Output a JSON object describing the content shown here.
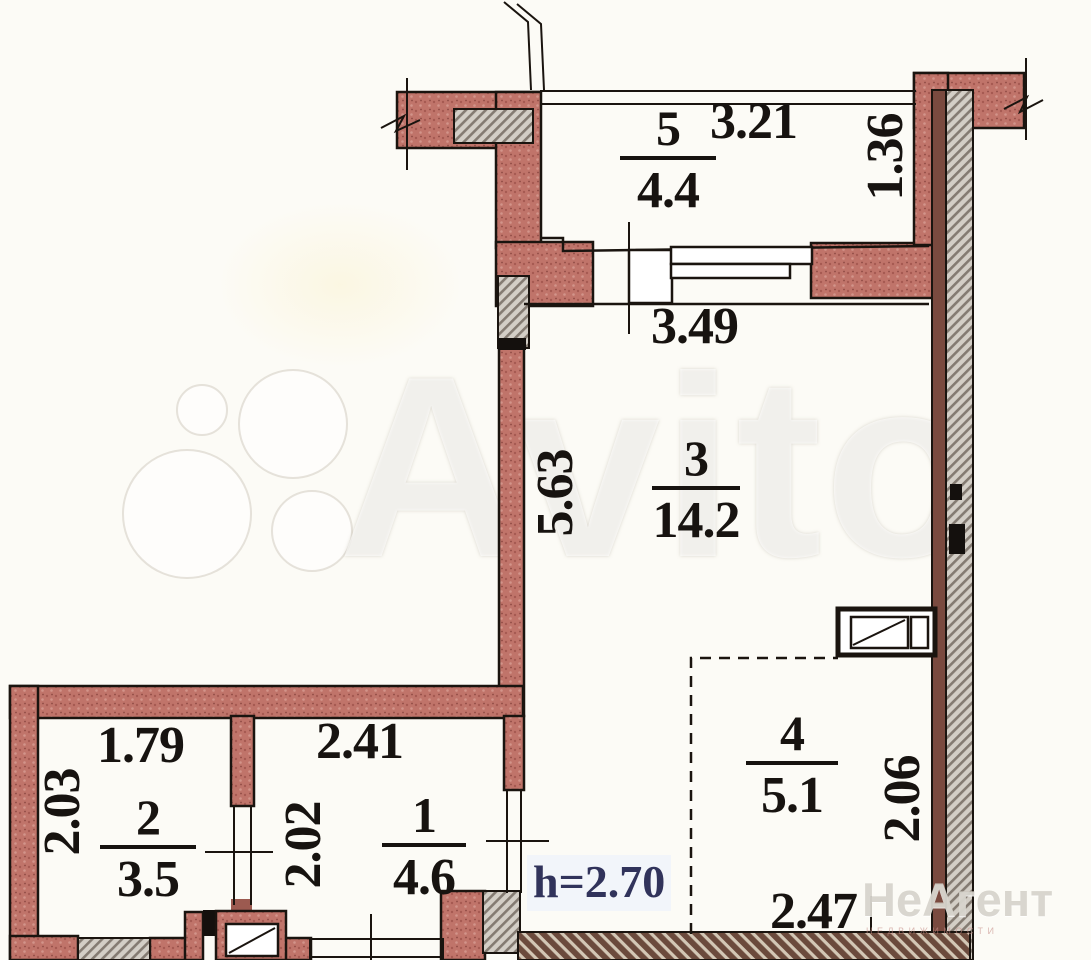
{
  "title": "apartment floor plan",
  "rooms": [
    {
      "number": "5",
      "area": "4.4"
    },
    {
      "number": "3",
      "area": "14.2"
    },
    {
      "number": "2",
      "area": "3.5"
    },
    {
      "number": "1",
      "area": "4.6"
    },
    {
      "number": "4",
      "area": "5.1"
    }
  ],
  "dimensions": {
    "top_width": "3.21",
    "top_right_depth": "1.36",
    "balcony_opening": "3.49",
    "room3_height": "5.63",
    "room2_width": "1.79",
    "room2_height": "2.03",
    "room1_width": "2.41",
    "room1_height": "2.02",
    "room4_height": "2.06",
    "room4_width": "2.47"
  },
  "ceiling_height_label": "h=2.70",
  "watermarks": {
    "marketplace": "Avito",
    "agency": "НеАгент",
    "agency_tagline": "недвижимости"
  },
  "colors": {
    "wall_brick": "#c0746a",
    "wall_gray": "#d3cec6",
    "wall_dark": "#6b4a3c",
    "outline": "#1a140f",
    "height_text": "#31335b"
  }
}
